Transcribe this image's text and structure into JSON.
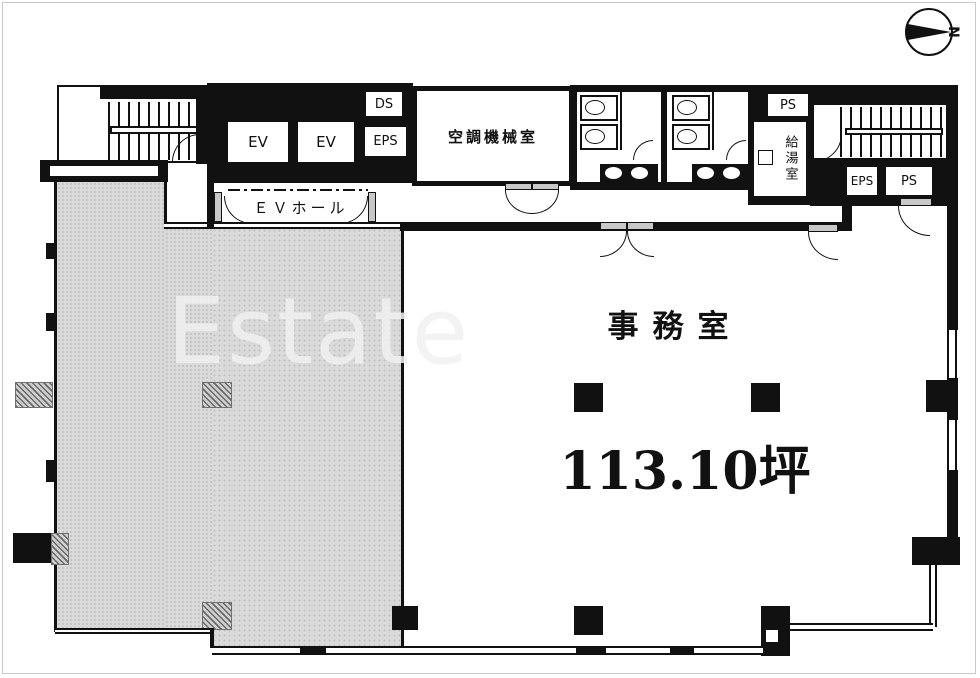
{
  "compass": {
    "north_label": "N"
  },
  "watermark": {
    "text": "Estate"
  },
  "labels": {
    "ev1": "EV",
    "ev2": "EV",
    "ds": "DS",
    "eps_core": "EPS",
    "ac_room": "空調機械室",
    "ev_hall": "ＥＶホール",
    "ps_top": "PS",
    "kitchenette": "給湯室",
    "eps_right": "EPS",
    "ps_right": "PS",
    "office_name": "事務室",
    "office_area": "113.10坪"
  },
  "colors": {
    "wall": "#111111",
    "tenant_hatch_area": "#dadada",
    "watermark_text": "#f1f1f1"
  }
}
